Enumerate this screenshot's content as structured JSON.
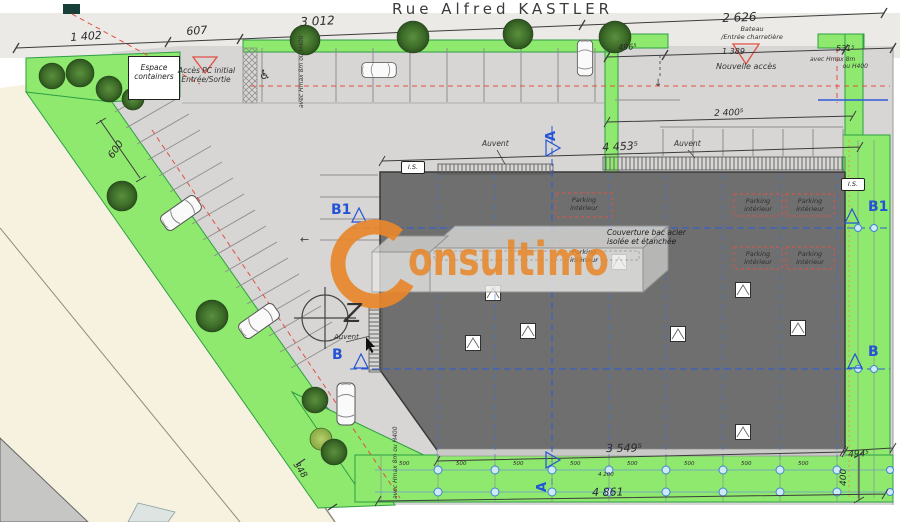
{
  "street": {
    "name": "Rue Alfred KASTLER"
  },
  "watermark": {
    "brand": "Consultimo",
    "display_rest": "onsultimo",
    "color": "#e8872b"
  },
  "dimensions": {
    "top": {
      "d1402": "1 402",
      "d607": "607",
      "d3012": "3 012",
      "d2626": "2 626"
    },
    "entry": {
      "d496": "496⁵",
      "d1389": "1 389",
      "d531": "531⁵"
    },
    "court": {
      "d2400": "2 400⁵",
      "d4453": "4 453⁵",
      "d600": "600"
    },
    "bottom": {
      "d3549": "3 549⁵",
      "d4861": "4 861",
      "d494": "494⁵",
      "d400": "400",
      "d348": "348",
      "d4200": "4 200",
      "module": "500"
    }
  },
  "annotations": {
    "espace_containers_1": "Espace",
    "espace_containers_2": "containers",
    "acces_pc_1": "Accès PC initial",
    "acces_pc_2": "Entrée/Sortie",
    "bateau_1": "Bateau",
    "bateau_2": "/Entrée charretière",
    "nouvelle_acces": "Nouvelle accès",
    "auvent": "Auvent",
    "is": "I.S.",
    "parking_1": "Parking",
    "parking_2": "intérieur",
    "couverture_1": "Couverture bac acier",
    "couverture_2": "isolée et étanchée",
    "hedge_note_1": "avec Hmax 8m",
    "hedge_note_2": "ou H400"
  },
  "sections": {
    "a": "A",
    "b": "B",
    "b1": "B1",
    "north": "Z"
  },
  "icons": {
    "wheelchair": "♿",
    "arrow_left": "←",
    "arrow_down": "↓"
  },
  "colors": {
    "green": "#8ee96e",
    "building_gray": "#6f6f6f",
    "accent_orange": "#e8872b",
    "section_blue": "#2453d6",
    "alignment_red": "#e05043",
    "road_beige": "#f7f2e0"
  }
}
